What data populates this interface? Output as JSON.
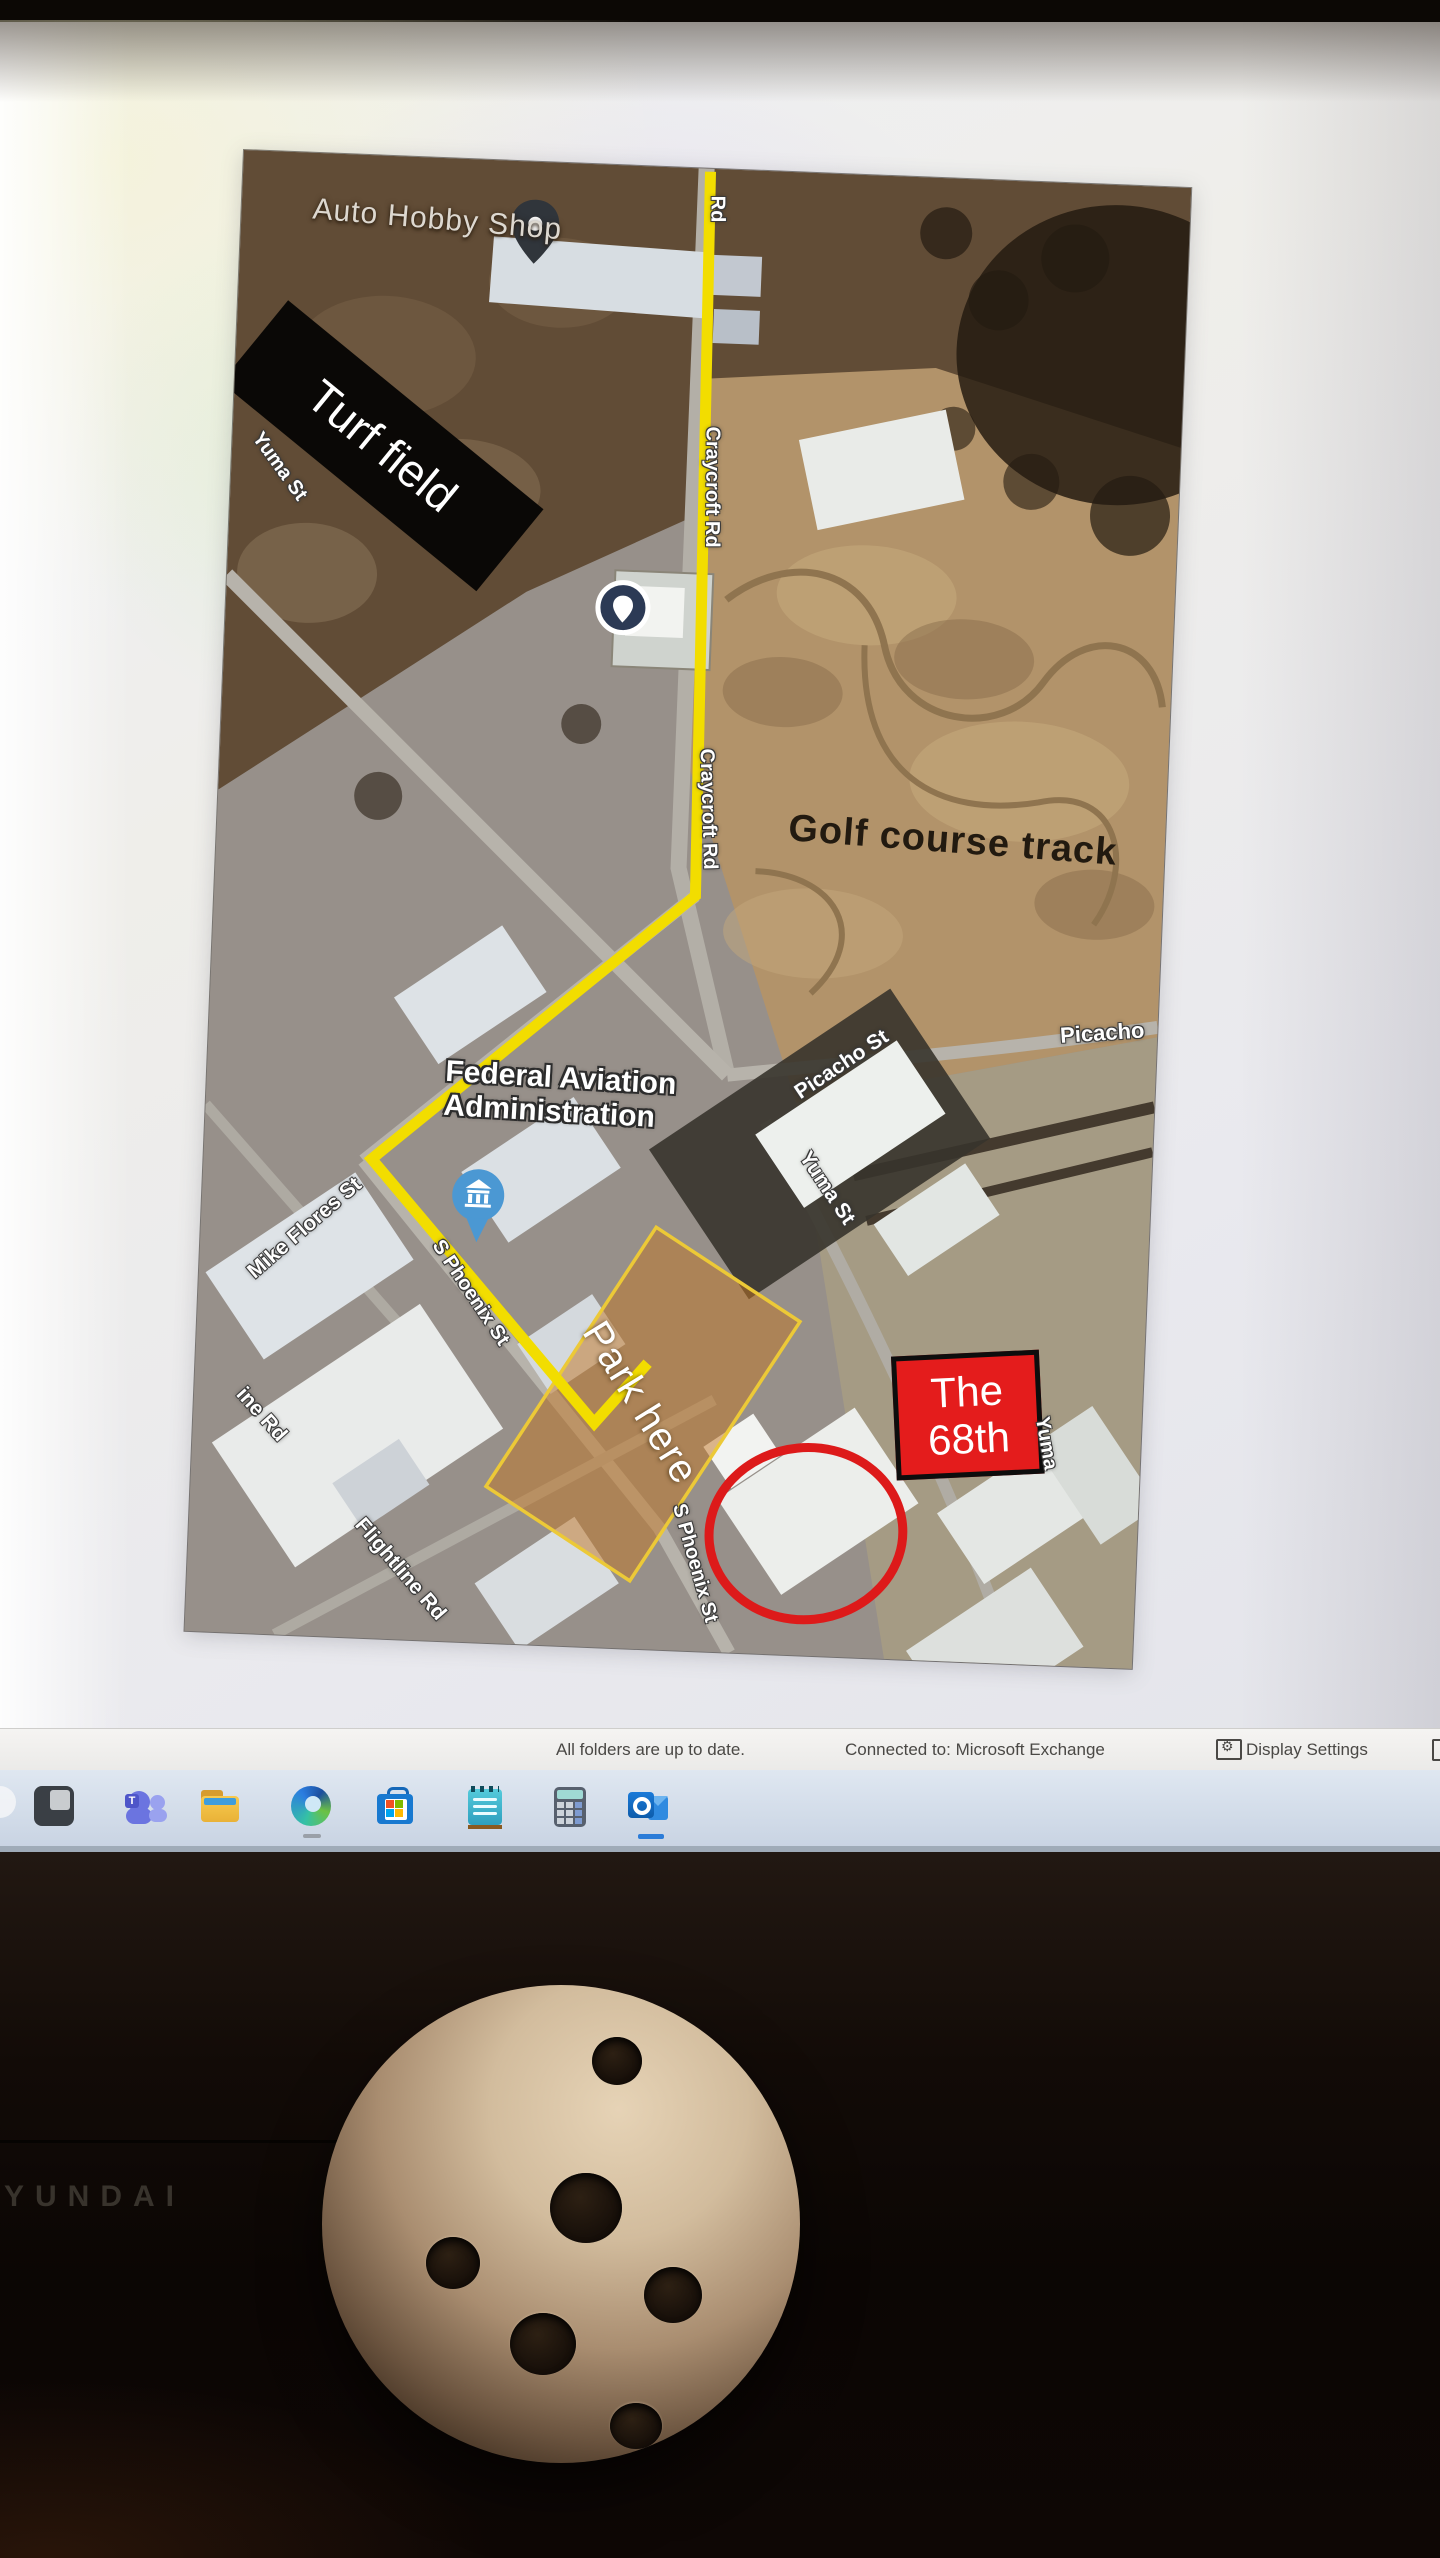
{
  "screen": {
    "status_bar": {
      "folders_status": "All folders are up to date.",
      "connection_status": "Connected to: Microsoft Exchange",
      "display_settings_label": "Display Settings"
    },
    "taskbar": {
      "icons": [
        "partial-icon",
        "dark-app-icon",
        "teams-icon",
        "file-explorer-icon",
        "edge-icon",
        "store-icon",
        "notepad-icon",
        "calculator-icon",
        "outlook-icon"
      ]
    }
  },
  "map": {
    "poi": {
      "auto_hobby_shop": "Auto Hobby Shop",
      "turf_field": "Turf field",
      "golf_course_track": "Golf course track",
      "faa_line1": "Federal Aviation",
      "faa_line2": "Administration",
      "park_here": "Park here",
      "unit_box_line1": "The",
      "unit_box_line2": "68th"
    },
    "streets": {
      "yuma_st_nw": "Yuma St",
      "craycroft_rd_top": "Rd",
      "craycroft_rd_upper": "Craycroft Rd",
      "craycroft_rd_lower": "Craycroft Rd",
      "picacho_st": "Picacho St",
      "picacho_edge": "Picacho",
      "yuma_st_mid": "Yuma St",
      "yuma_edge": "Yuma",
      "mike_flores_st": "Mike Flores St",
      "s_phoenix_st_upper": "S Phoenix St",
      "s_phoenix_st_lower": "S Phoenix St",
      "ine_rd": "ine Rd",
      "flightline_rd": "Flightline Rd"
    }
  },
  "colors": {
    "route_yellow": "#f2dd00",
    "red_accent": "#dd1a1a",
    "park_fill": "rgba(193,118,36,0.5)",
    "park_stroke": "#ecc937",
    "unit_box_red": "#e41c1c"
  },
  "monitor": {
    "brand_label": "YUNDAI"
  }
}
